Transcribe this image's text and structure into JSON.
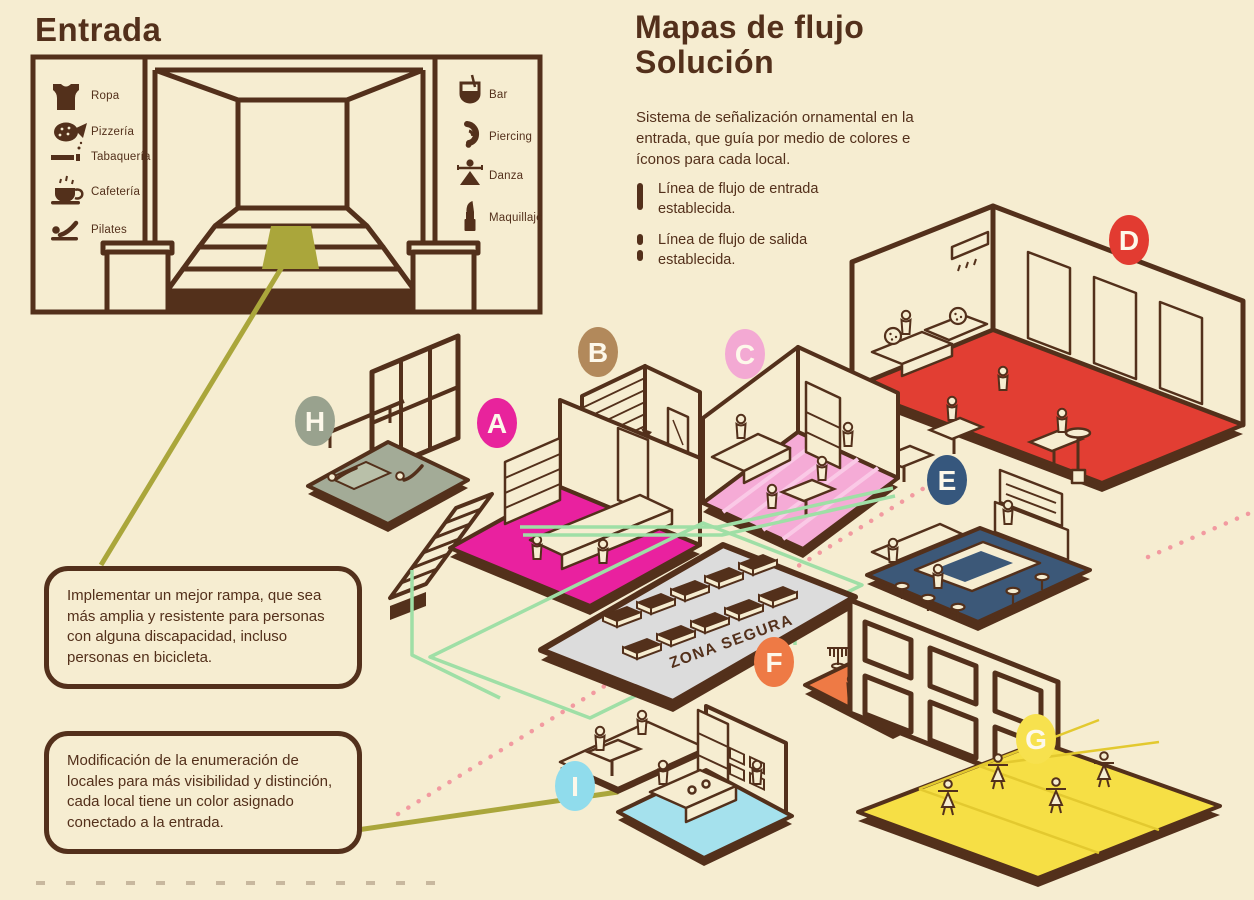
{
  "colors": {
    "background": "#f6edd1",
    "ink": "#53301b",
    "olive_ramp_line": "#aaa63b",
    "entrance_flow_line": "#9fdfa6",
    "exit_flow_dots": "#f29aa0",
    "safe_zone_fill": "#dcdcdc"
  },
  "entrada": {
    "title": "Entrada",
    "legend_left": [
      {
        "icon": "tank-top-icon",
        "label": "Ropa"
      },
      {
        "icon": "pizza-icon",
        "label": "Pizzería"
      },
      {
        "icon": "cigarette-icon",
        "label": "Tabaquería"
      },
      {
        "icon": "coffee-cup-icon",
        "label": "Cafetería"
      },
      {
        "icon": "exercise-person-icon",
        "label": "Pilates"
      }
    ],
    "legend_right": [
      {
        "icon": "bar-glass-icon",
        "label": "Bar"
      },
      {
        "icon": "ear-piercing-icon",
        "label": "Piercing"
      },
      {
        "icon": "dancer-icon",
        "label": "Danza"
      },
      {
        "icon": "lipstick-icon",
        "label": "Maquillaje"
      }
    ]
  },
  "solution": {
    "title_line1": "Mapas de flujo",
    "title_line2": "Solución",
    "description": "Sistema de señalización ornamental en la entrada, que guía por medio de colores e íconos para cada local.",
    "flow_legend": [
      {
        "style": "solid",
        "label": "Línea de flujo de entrada establecida."
      },
      {
        "style": "dashed",
        "label": "Línea de flujo de salida establecida."
      }
    ]
  },
  "annotations": {
    "ramp_note": "Implementar un mejor rampa, que sea más amplia y resistente para personas con alguna discapacidad, incluso personas en bicicleta.",
    "numbering_note": "Modificación de la enumeración de locales para más visibilidad y distinción, cada local tiene un color asignado conectado a la entrada."
  },
  "map": {
    "safe_zone_label": "ZONA SEGURA",
    "rooms": [
      {
        "letter": "A",
        "badge_color": "#e8239c",
        "floor_color": "#e9219f",
        "depicts": "shop with counter and shelves"
      },
      {
        "letter": "B",
        "badge_color": "#b2895b",
        "floor_color": "#cba47a",
        "depicts": "piercing studio with brick wall and mirror"
      },
      {
        "letter": "C",
        "badge_color": "#f3a9d3",
        "floor_color": "#f5abd6",
        "depicts": "makeup salon with striped floor"
      },
      {
        "letter": "D",
        "badge_color": "#e23b31",
        "floor_color": "#e23e33",
        "depicts": "pizzeria with chef counter and tables"
      },
      {
        "letter": "E",
        "badge_color": "#36577d",
        "floor_color": "#3c5878",
        "depicts": "bar with stools and counter"
      },
      {
        "letter": "F",
        "badge_color": "#ee7a45",
        "floor_color": "#ee7a45",
        "depicts": "clothing store with racks"
      },
      {
        "letter": "G",
        "badge_color": "#f7e14e",
        "floor_color": "#f6df45",
        "depicts": "dance hall with dancers"
      },
      {
        "letter": "H",
        "badge_color": "#99a28e",
        "floor_color": "#a3ab97",
        "depicts": "pilates studio with mats and barre"
      },
      {
        "letter": "I",
        "badge_color": "#90dcec",
        "floor_color": "#a5e1ed",
        "depicts": "cafeteria with kitchen counter"
      }
    ]
  }
}
